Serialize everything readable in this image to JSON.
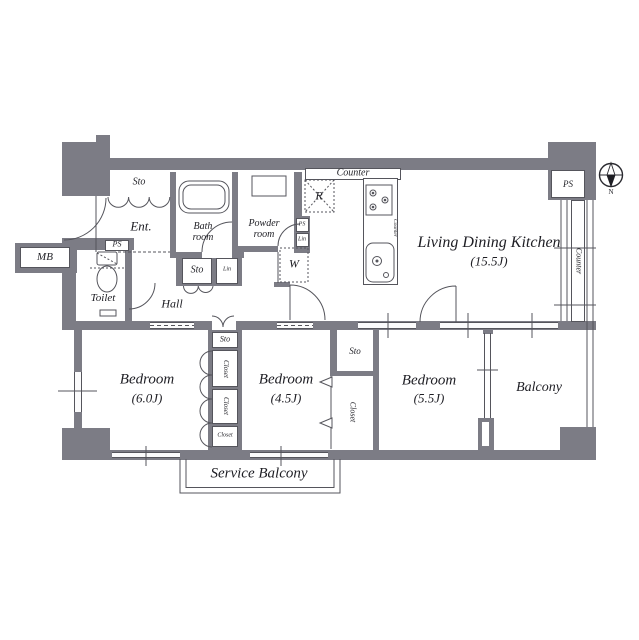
{
  "plan": {
    "rooms": {
      "ldk": {
        "name": "Living Dining Kitchen",
        "size": "(15.5J)"
      },
      "bedroom_6": {
        "name": "Bedroom",
        "size": "(6.0J)"
      },
      "bedroom_45": {
        "name": "Bedroom",
        "size": "(4.5J)"
      },
      "bedroom_55": {
        "name": "Bedroom",
        "size": "(5.5J)"
      },
      "balcony": {
        "name": "Balcony"
      },
      "service_balcony": {
        "name": "Service Balcony"
      },
      "entrance": {
        "name": "Ent."
      },
      "hall": {
        "name": "Hall"
      },
      "toilet": {
        "name": "Toilet"
      },
      "bath": {
        "line1": "Bath",
        "line2": "room"
      },
      "powder": {
        "line1": "Powder",
        "line2": "room"
      }
    },
    "fixtures": {
      "sto": "Sto",
      "closet": "Closet",
      "lin": "Lin",
      "ps": "PS",
      "mb": "MB",
      "counter": "Counter",
      "refrigerator": "R",
      "washer": "W"
    },
    "compass": {
      "north": "N"
    }
  },
  "colors": {
    "wall": "#7c7c85",
    "line": "#55555c",
    "text": "#1e1e24"
  }
}
